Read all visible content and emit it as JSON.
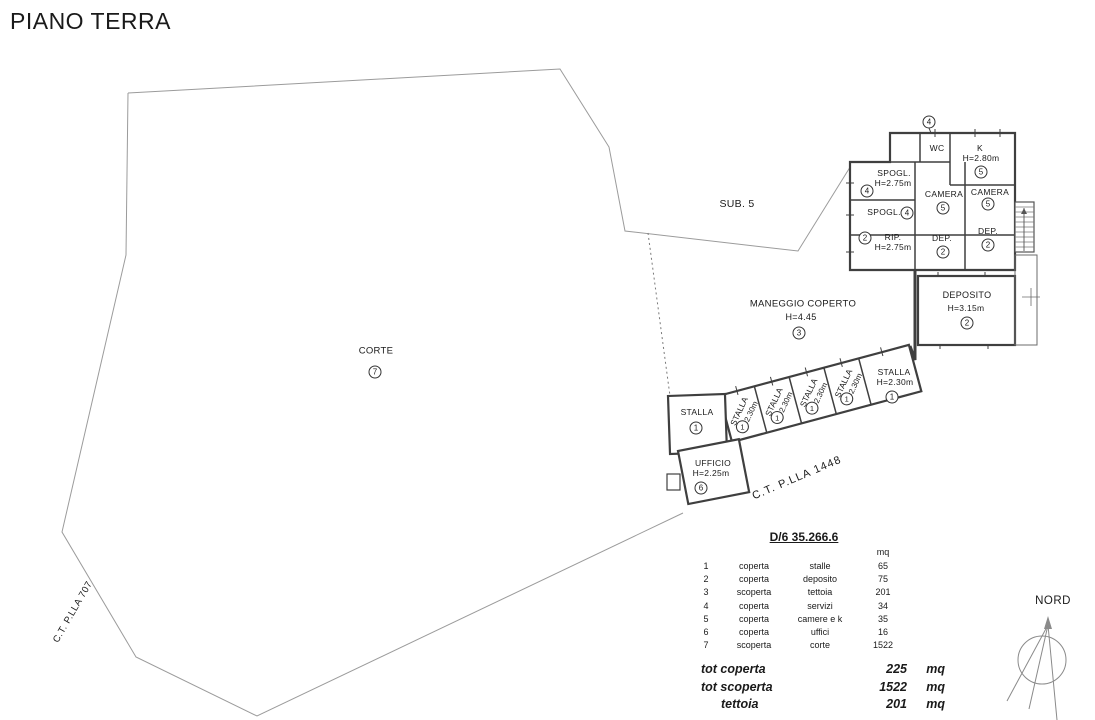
{
  "page": {
    "title": "PIANO TERRA"
  },
  "site": {
    "sub_label": "SUB. 5",
    "parcel_left_label": "C.T. P.LLA 707",
    "parcel_bottom_label": "C.T. P.LLA 1448",
    "north_label": "NORD"
  },
  "rooms": {
    "corte": {
      "name": "CORTE",
      "num": "7"
    },
    "maneggio": {
      "name": "MANEGGIO COPERTO",
      "height": "H=4.45",
      "num": "3"
    },
    "deposito": {
      "name": "DEPOSITO",
      "height": "H=3.15m",
      "num": "2"
    },
    "wc": {
      "name": "WC",
      "num": "4"
    },
    "k": {
      "name": "K",
      "height": "H=2.80m",
      "num": "5"
    },
    "spogl_top": {
      "name": "SPOGL.",
      "height": "H=2.75m",
      "num": "4"
    },
    "spogl_bottom": {
      "name": "SPOGL.",
      "num": "4"
    },
    "rip": {
      "name": "RIP.",
      "height": "H=2.75m",
      "num": "2"
    },
    "camera_left": {
      "name": "CAMERA",
      "num": "5"
    },
    "camera_right": {
      "name": "CAMERA",
      "num": "5"
    },
    "dep_left": {
      "name": "DEP.",
      "num": "2"
    },
    "dep_right": {
      "name": "DEP.",
      "num": "2"
    },
    "entry_marker": {
      "num": "4"
    },
    "stalla_square": {
      "name": "STALLA",
      "num": "1"
    },
    "ufficio": {
      "name": "UFFICIO",
      "height": "H=2.25m",
      "num": "6"
    },
    "stalla_box": {
      "name": "STALLA",
      "height": "H=2.30m",
      "num": "1"
    },
    "stalla_end": {
      "name": "STALLA",
      "height": "H=2.30m",
      "num": "1"
    }
  },
  "table": {
    "title": "D/6 35.266.6",
    "unit_header": "mq",
    "rows": [
      {
        "num": "1",
        "coverage": "coperta",
        "use": "stalle",
        "area": "65"
      },
      {
        "num": "2",
        "coverage": "coperta",
        "use": "deposito",
        "area": "75"
      },
      {
        "num": "3",
        "coverage": "scoperta",
        "use": "tettoia",
        "area": "201"
      },
      {
        "num": "4",
        "coverage": "coperta",
        "use": "servizi",
        "area": "34"
      },
      {
        "num": "5",
        "coverage": "coperta",
        "use": "camere e k",
        "area": "35"
      },
      {
        "num": "6",
        "coverage": "coperta",
        "use": "uffici",
        "area": "16"
      },
      {
        "num": "7",
        "coverage": "scoperta",
        "use": "corte",
        "area": "1522"
      }
    ],
    "totals": [
      {
        "label": "tot coperta",
        "value": "225",
        "unit": "mq"
      },
      {
        "label": "tot scoperta",
        "value": "1522",
        "unit": "mq"
      },
      {
        "label": "tettoia",
        "value": "201",
        "unit": "mq"
      }
    ]
  },
  "colors": {
    "boundary": "#9b9b9b",
    "wall": "#3f3f3f",
    "text": "#1a1a1a"
  }
}
